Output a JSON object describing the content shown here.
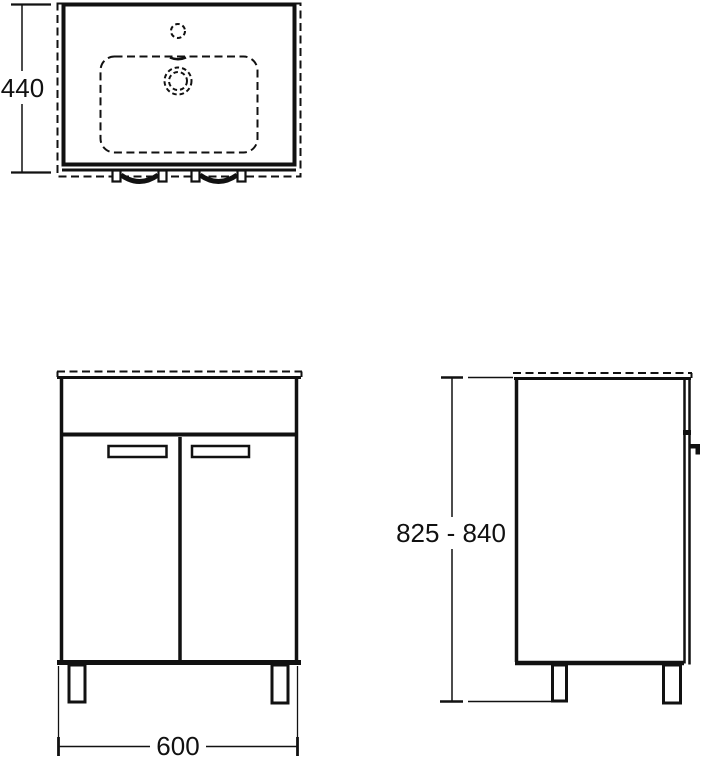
{
  "drawing": {
    "background_color": "#ffffff",
    "line_color": "#111111",
    "dimensions": {
      "plan_depth": "440",
      "front_width": "600",
      "height_range": "825 - 840"
    }
  }
}
